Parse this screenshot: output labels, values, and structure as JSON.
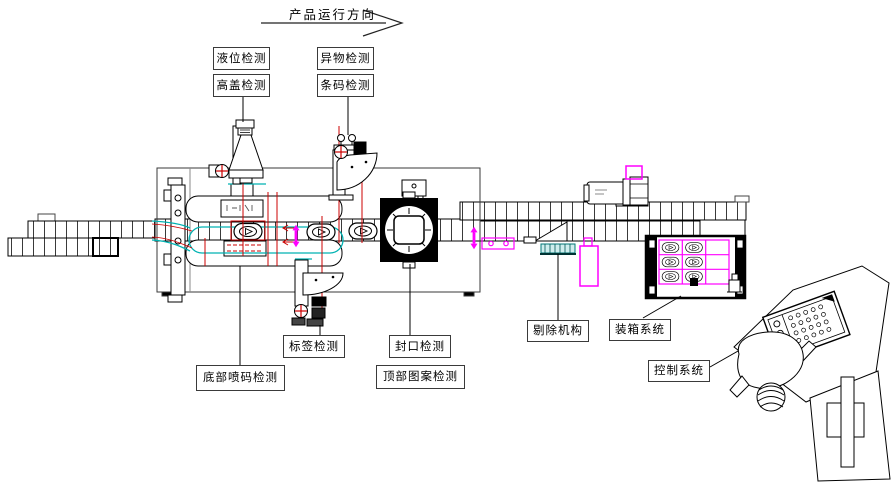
{
  "direction": {
    "label": "产品运行方向"
  },
  "labels": {
    "liquid_level": "液位检测",
    "high_cap": "高盖检测",
    "foreign_object": "异物检测",
    "barcode": "条码检测",
    "label_check": "标签检测",
    "seal": "封口检测",
    "bottom_inkjet": "底部喷码检测",
    "top_pattern": "顶部图案检测",
    "reject": "剔除机构",
    "boxing": "装箱系统",
    "control": "控制系统"
  },
  "colors": {
    "line_art": "#000000",
    "detection_beam_red": "#cc0000",
    "marker_magenta": "#ff00ff",
    "guide_rail_cyan": "#00b2b2",
    "machine_black": "#000000",
    "background": "#ffffff"
  }
}
